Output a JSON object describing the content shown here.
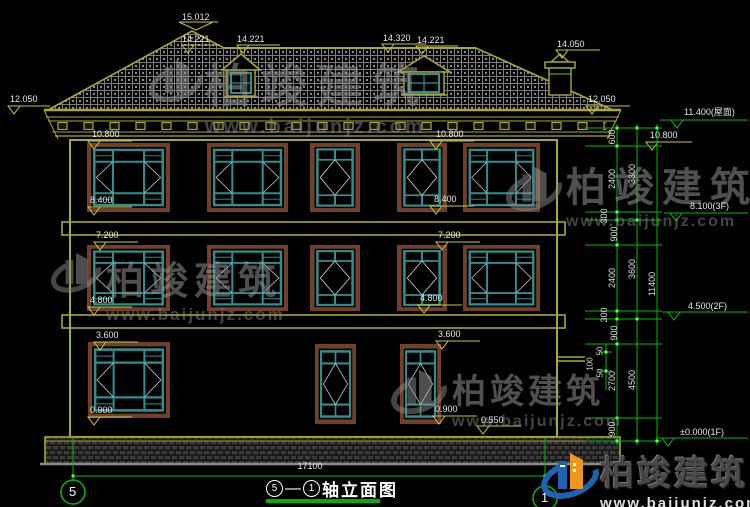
{
  "watermark": {
    "brand": "柏竣建筑",
    "url": "www.baijunjz.com"
  },
  "title": {
    "axis_left": "5",
    "dash": "—",
    "axis_right": "1",
    "name": "轴立面图"
  },
  "axis_bubbles": {
    "left": "5",
    "right": "1"
  },
  "dimensions": {
    "total_width": "17100",
    "inner_chain": [
      "600",
      "2400",
      "300",
      "900",
      "2400",
      "300",
      "900",
      "2700",
      "900"
    ],
    "middle_chain": [
      "3300",
      "3600",
      "4500"
    ],
    "overall": "11400",
    "ledge_detail": [
      "100",
      "50",
      "50"
    ]
  },
  "levels": {
    "roof": {
      "ridge": "15.012",
      "upper_left": "14.221",
      "dormer_left": "14.221",
      "ridge_right": "14.320",
      "dormer_right": "14.221",
      "chimney": "14.050",
      "eave_left": "12.050",
      "eave_right": "12.050"
    },
    "left": [
      "10.800",
      "8.400",
      "7.200",
      "4.800",
      "3.600",
      "0.900"
    ],
    "mid": [
      "10.800",
      "8.400",
      "7.200",
      "4.800",
      "3.600",
      "0.900",
      "0.550"
    ],
    "right": {
      "roof_surface": "11.400(屋面)",
      "window_top": "10.800",
      "floor3": "8.100(3F)",
      "floor2": "4.500(2F)",
      "floor1": "±0.000(1F)"
    }
  },
  "colors": {
    "line_yellow": "#a8a832",
    "line_green": "#00bb00",
    "window_teal": "#2f8f8f",
    "frame_brown": "#70402a",
    "logo_blue": "#1e63b0",
    "logo_orange": "#f0951e"
  }
}
